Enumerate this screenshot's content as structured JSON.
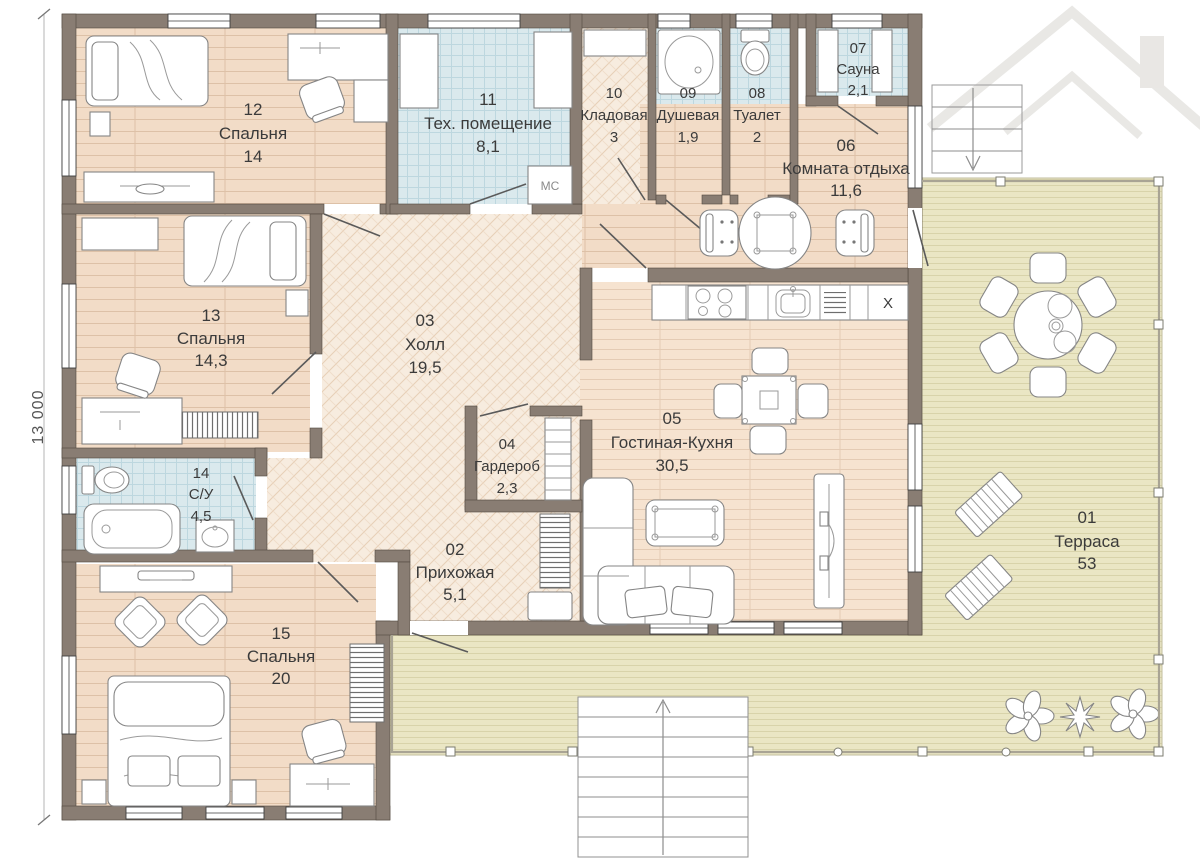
{
  "dimension": {
    "left_total": "13 000"
  },
  "rooms": {
    "r01": {
      "num": "01",
      "name": "Терраса",
      "area": "53"
    },
    "r02": {
      "num": "02",
      "name": "Прихожая",
      "area": "5,1"
    },
    "r03": {
      "num": "03",
      "name": "Холл",
      "area": "19,5"
    },
    "r04": {
      "num": "04",
      "name": "Гардероб",
      "area": "2,3"
    },
    "r05": {
      "num": "05",
      "name": "Гостиная-Кухня",
      "area": "30,5"
    },
    "r06": {
      "num": "06",
      "name": "Комната отдыха",
      "area": "11,6"
    },
    "r07": {
      "num": "07",
      "name": "Сауна",
      "area": "2,1"
    },
    "r08": {
      "num": "08",
      "name": "Туалет",
      "area": "2"
    },
    "r09": {
      "num": "09",
      "name": "Душевая",
      "area": "1,9"
    },
    "r10": {
      "num": "10",
      "name": "Кладовая",
      "area": "3"
    },
    "r11": {
      "num": "11",
      "name": "Тех. помещение",
      "area": "8,1"
    },
    "r12": {
      "num": "12",
      "name": "Спальня",
      "area": "14"
    },
    "r13": {
      "num": "13",
      "name": "Спальня",
      "area": "14,3"
    },
    "r14": {
      "num": "14",
      "name": "С/У",
      "area": "4,5"
    },
    "r15": {
      "num": "15",
      "name": "Спальня",
      "area": "20"
    }
  },
  "annotations": {
    "washing_machine": "МС",
    "kitchen_unit": "X"
  },
  "watermark": {
    "text": "KvartWell.kz"
  },
  "colors": {
    "wall": "#897d73",
    "wood": "#f2dcc7",
    "tile": "#dae9ed",
    "terrace": "#eae6c4",
    "herringbone": "#f7ecdf"
  }
}
